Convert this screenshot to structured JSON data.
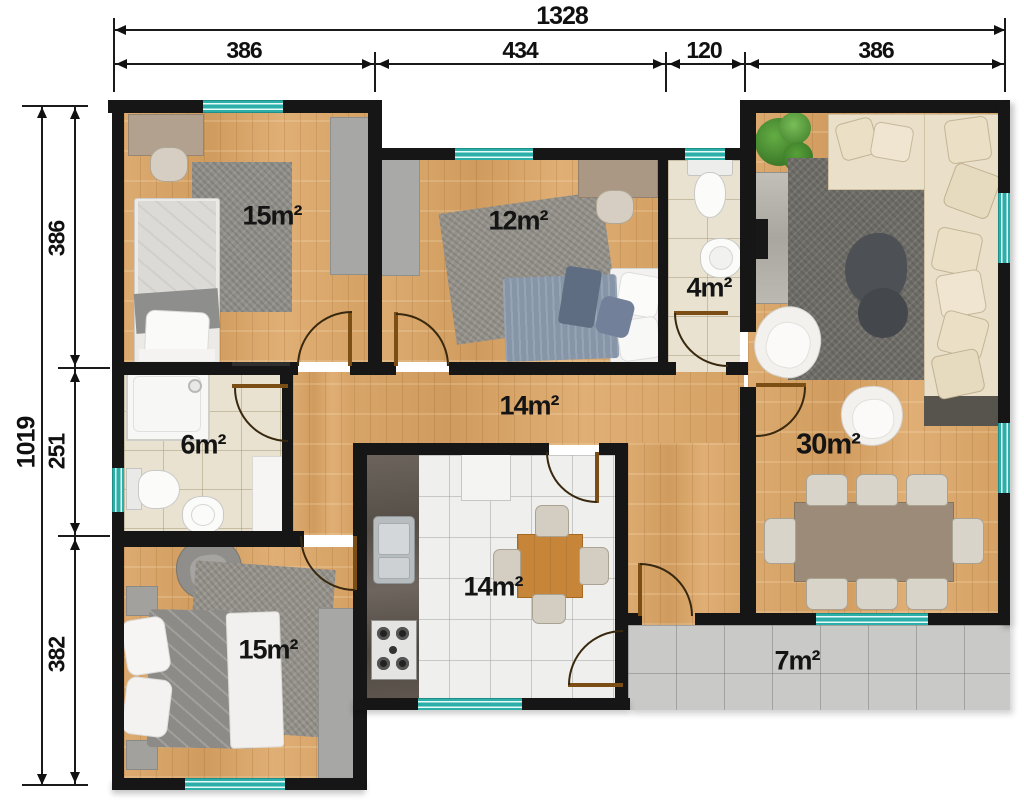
{
  "dimensions": {
    "top": {
      "total": "1328",
      "segments": [
        "386",
        "434",
        "120",
        "386"
      ]
    },
    "left": {
      "total": "1019",
      "segments": [
        "386",
        "251",
        "382"
      ]
    }
  },
  "rooms": {
    "bedroom_top_left": {
      "label": "15m²"
    },
    "bedroom_middle": {
      "label": "12m²"
    },
    "bathroom_small": {
      "label": "4m²"
    },
    "living_room": {
      "label": "30m²"
    },
    "bathroom": {
      "label": "6m²"
    },
    "hallway": {
      "label": "14m²"
    },
    "kitchen": {
      "label": "14m²"
    },
    "bedroom_bottom_left": {
      "label": "15m²"
    },
    "terrace": {
      "label": "7m²"
    }
  },
  "colors": {
    "wall": "#161616",
    "window": "#2cafa9",
    "wood_floor": "#d9a76c",
    "bath_tile": "#e9e2d0",
    "kitchen_tile": "#efefed",
    "terrace_tile": "#c9c9c7",
    "dimension_text": "#101010"
  }
}
